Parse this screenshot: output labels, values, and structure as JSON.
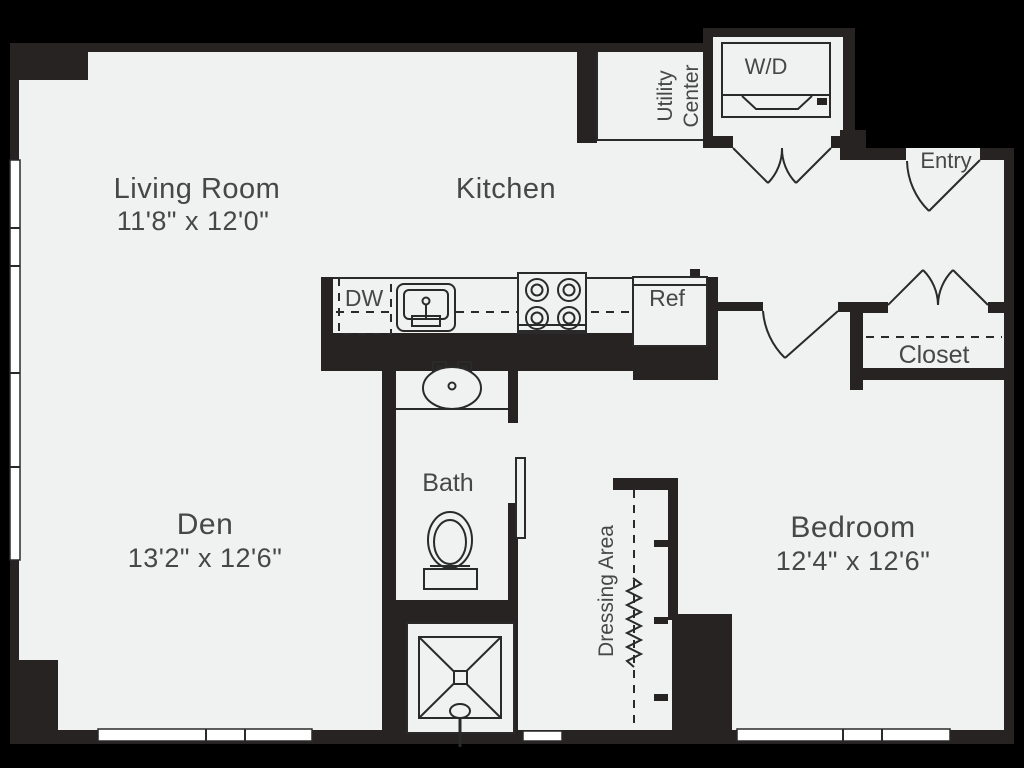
{
  "rooms": {
    "living_room": {
      "label": "Living Room",
      "dims": "11'8\" x 12'0\""
    },
    "kitchen": {
      "label": "Kitchen"
    },
    "den": {
      "label": "Den",
      "dims": "13'2\" x 12'6\""
    },
    "bedroom": {
      "label": "Bedroom",
      "dims": "12'4\" x 12'6\""
    },
    "bath": {
      "label": "Bath"
    },
    "dressing_area": {
      "label": "Dressing Area"
    },
    "closet": {
      "label": "Closet"
    },
    "entry": {
      "label": "Entry"
    },
    "utility_center": {
      "line1": "Utility",
      "line2": "Center"
    }
  },
  "appliances": {
    "washer_dryer": "W/D",
    "dishwasher": "DW",
    "refrigerator": "Ref"
  },
  "colors": {
    "background": "#000000",
    "wall": "#262322",
    "floor": "#f0f1f1",
    "window": "#ffffff",
    "stroke": "#2a2a2a",
    "text": "#474747"
  }
}
